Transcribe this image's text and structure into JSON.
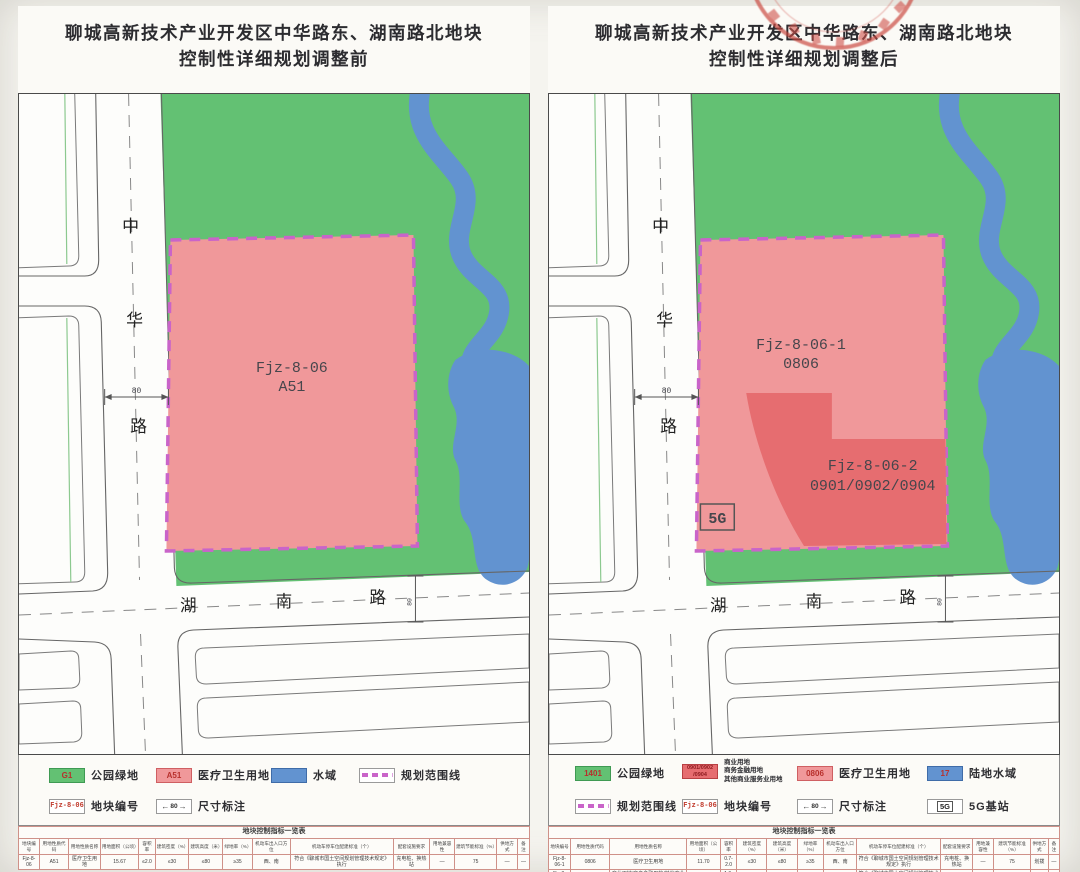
{
  "colors": {
    "park_green": "#63c173",
    "hospital_pink": "#f0989a",
    "commercial_red": "#e66d70",
    "water_blue": "#6293d0",
    "boundary_magenta": "#c964c9",
    "stamp_red": "#c9463d"
  },
  "panels": {
    "left": {
      "title_line1": "聊城高新技术产业开发区中华路东、湖南路北地块",
      "title_line2": "控制性详细规划调整前",
      "map": {
        "road_v": {
          "c0": "中",
          "c1": "华",
          "c2": "路"
        },
        "road_h": {
          "c0": "湖",
          "c1": "南",
          "c2": "路"
        },
        "dim1": "80",
        "dim2": "80",
        "parcel": {
          "line1": "Fjz-8-06",
          "line2": "A51"
        }
      },
      "legend": {
        "items": [
          {
            "code": "G1",
            "label": "公园绿地"
          },
          {
            "code": "A51",
            "label": "医疗卫生用地"
          },
          {
            "code": "",
            "label": "水域"
          },
          {
            "code": "",
            "label": "规划范围线"
          },
          {
            "code": "Fjz-8-06",
            "label": "地块编号"
          },
          {
            "code": "80",
            "label": "尺寸标注"
          }
        ]
      },
      "table": {
        "title": "地块控制指标一览表",
        "headers": [
          "地块编号",
          "用地性质代码",
          "用地性质名称",
          "用地面积（公顷）",
          "容积率",
          "建筑密度（%）",
          "建筑高度（米）",
          "绿地率（%）",
          "机动车出入口方位",
          "机动车停车位配建标准（个）",
          "配套设施要求",
          "用地兼容性",
          "建筑节能标准（%）",
          "供地方式",
          "备注"
        ],
        "rows": [
          [
            "Fjz-8-06",
            "A51",
            "医疗卫生用地",
            "15.67",
            "≤2.0",
            "≤30",
            "≤80",
            "≥35",
            "西、南",
            "符合《聊城市国土空间规划管理技术规定》执行",
            "充电桩、换热站",
            "—",
            "75",
            "—",
            "—"
          ]
        ]
      }
    },
    "right": {
      "title_line1": "聊城高新技术产业开发区中华路东、湖南路北地块",
      "title_line2": "控制性详细规划调整后",
      "map": {
        "road_v": {
          "c0": "中",
          "c1": "华",
          "c2": "路"
        },
        "road_h": {
          "c0": "湖",
          "c1": "南",
          "c2": "路"
        },
        "dim1": "80",
        "dim2": "80",
        "parcel1": {
          "line1": "Fjz-8-06-1",
          "line2": "0806"
        },
        "parcel2": {
          "line1": "Fjz-8-06-2",
          "line2": "0901/0902/0904"
        },
        "bts": "5G"
      },
      "legend": {
        "items": [
          {
            "code": "1401",
            "label": "公园绿地"
          },
          {
            "code_l1": "0901/0902",
            "code_l2": "/0904",
            "label_l1": "商业用地",
            "label_l2": "商务金融用地",
            "label_l3": "其他商业服务业用地"
          },
          {
            "code": "0806",
            "label": "医疗卫生用地"
          },
          {
            "code": "17",
            "label": "陆地水域"
          },
          {
            "code": "",
            "label": "规划范围线"
          },
          {
            "code": "Fjz-8-06",
            "label": "地块编号"
          },
          {
            "code": "80",
            "label": "尺寸标注"
          },
          {
            "code": "5G",
            "label": "5G基站"
          }
        ]
      },
      "table": {
        "title": "地块控制指标一览表",
        "headers": [
          "地块编号",
          "用地性质代码",
          "用地性质名称",
          "用地面积（公顷）",
          "容积率",
          "建筑密度（%）",
          "建筑高度（米）",
          "绿地率（%）",
          "机动车出入口方位",
          "机动车停车位配建标准（个）",
          "配套设施要求",
          "用地兼容性",
          "建筑节能标准（%）",
          "供地方式",
          "备注"
        ],
        "rows": [
          [
            "Fjz-8-06-1",
            "0806",
            "医疗卫生用地",
            "11.70",
            "0.7-2.0",
            "≤30",
            "≤80",
            "≥35",
            "西、南",
            "符合《聊城市国土空间规划管理技术规定》执行",
            "充电桩、换热站",
            "—",
            "75",
            "划拨",
            "—"
          ],
          [
            "Fjz-8-06-2",
            "0901/0902/0904",
            "商业用地/商务金融用地/其他商业服务业用地",
            "3.97",
            "1.0-3.0",
            "≤30",
            "≤80",
            "≥15",
            "南",
            "符合《聊城市国土空间规划管理技术规定》执行",
            "—",
            "—",
            "75",
            "出让",
            "—"
          ]
        ]
      }
    }
  }
}
